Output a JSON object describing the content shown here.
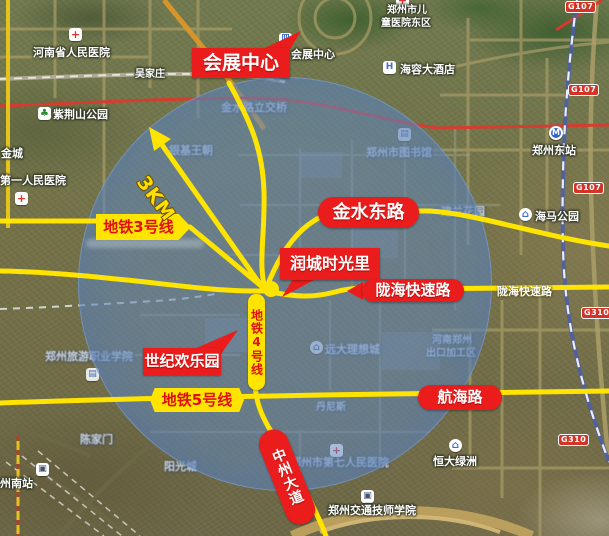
{
  "map": {
    "annotations": {
      "red_labels": {
        "convention_center": "会展中心",
        "runcheng": "润城时光里",
        "century_park": "世纪欢乐园",
        "jinshui_east_rd": "金水东路",
        "longhai_expwy": "陇海快速路",
        "hanghai_rd": "航海路",
        "zhongzhou_ave": "中州大道"
      },
      "metro_labels": {
        "line3": "地铁3号线",
        "line4": "地铁4号线",
        "line5": "地铁5号线"
      },
      "radius_label": "3KM"
    },
    "pois": [
      {
        "t": "河南省人民医院",
        "icon": "hospital-cross"
      },
      {
        "t": "吴家庄"
      },
      {
        "t": "紫荆山公园",
        "icon": "park-tree"
      },
      {
        "t": "金城"
      },
      {
        "t": "第一人民医院",
        "icon": "hospital-cross"
      },
      {
        "t": "金水路立交桥"
      },
      {
        "t": "银基王朝"
      },
      {
        "t": "会展中心",
        "icon": "convention-building"
      },
      {
        "t": "郑州市儿",
        "icon": "hospital-cross"
      },
      {
        "t": "童医院东区"
      },
      {
        "t": "海容大酒店",
        "icon": "hotel"
      },
      {
        "t": "郑州东站",
        "icon": "metro-station"
      },
      {
        "t": "海马公园",
        "icon": "home"
      },
      {
        "t": "建兰花园"
      },
      {
        "t": "郑州市图书馆",
        "icon": "library"
      },
      {
        "t": "远大理想城",
        "icon": "home"
      },
      {
        "t": "河南郑州"
      },
      {
        "t": "出口加工区"
      },
      {
        "t": "丹尼斯"
      },
      {
        "t": "陇海快速路"
      },
      {
        "t": "恒大绿洲",
        "icon": "home"
      },
      {
        "t": "郑州市第七人民医院",
        "icon": "hospital-cross"
      },
      {
        "t": "郑州交通技师学院",
        "icon": "building"
      },
      {
        "t": "阳光城"
      },
      {
        "t": "陈家门"
      },
      {
        "t": "州南站",
        "icon": "building"
      },
      {
        "t": "郑州旅游职业学院",
        "icon": "library"
      }
    ],
    "road_badges": [
      "G107",
      "G107",
      "G107",
      "G310",
      "G310"
    ],
    "colors": {
      "annotation_red": "#ea1c1c",
      "annotation_yellow": "#ffe400",
      "circle_blue": "rgba(98,136,190,0.55)",
      "railway_red": "#d93a2e"
    }
  }
}
